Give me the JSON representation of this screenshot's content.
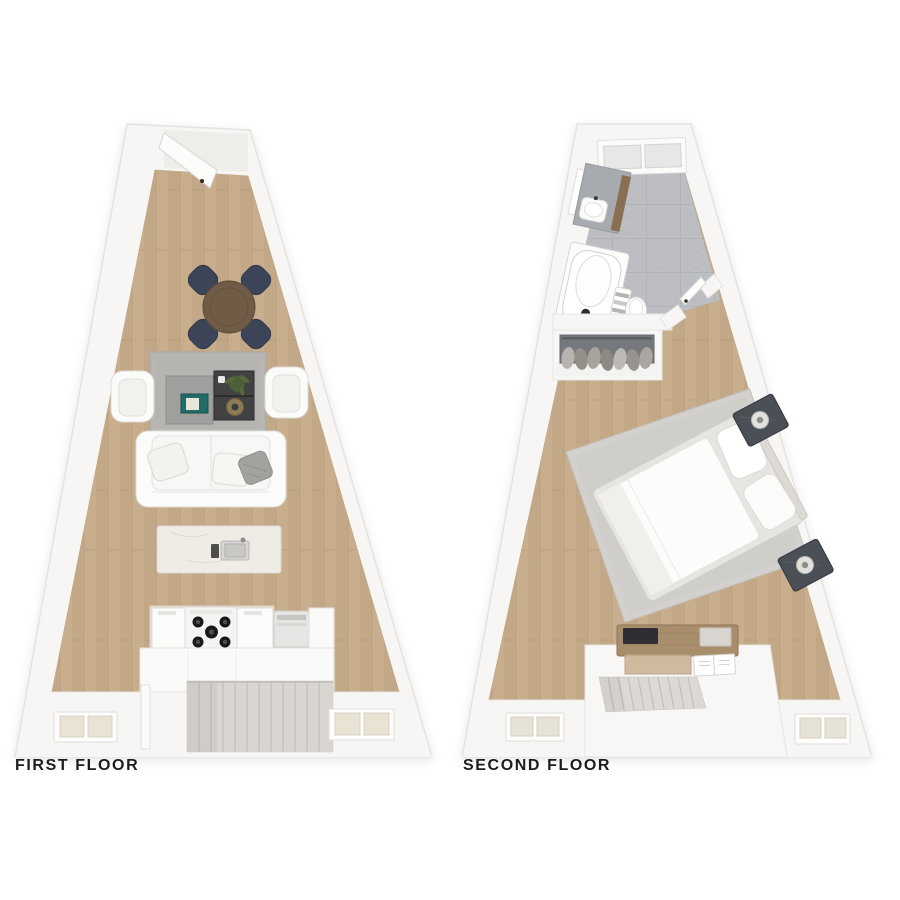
{
  "title": "Two-floor triangular apartment floor plan",
  "floors": [
    {
      "label": "FIRST FLOOR",
      "furniture": [
        "entry-door",
        "round-dining-table",
        "dining-chairs",
        "area-rug",
        "armchairs",
        "coffee-tables",
        "book",
        "plant",
        "sofa",
        "throw-pillows",
        "kitchen-island-with-sink",
        "kitchen-counter-with-stove",
        "appliance",
        "staircase",
        "partition-wall",
        "windows"
      ]
    },
    {
      "label": "SECOND FLOOR",
      "furniture": [
        "window",
        "bathroom-vanity-with-sink",
        "mirror",
        "bathtub",
        "towel-rack",
        "toilet",
        "bathroom-door",
        "closet-with-hanging-clothes",
        "bedroom-rug",
        "bed-with-pillows",
        "nightstands-with-lamps",
        "dresser",
        "wood-tray",
        "open-book",
        "staircase",
        "stair-half-wall",
        "windows"
      ]
    }
  ],
  "colors": {
    "background": "#ffffff",
    "label_text": "#1c1c1c",
    "wall": "#f7f6f4",
    "wall_edge": "#e5e3e0",
    "wood": "#c9ae8d",
    "wood_dark": "#bda081",
    "tile": "#bcbec2",
    "tile_line": "#adb0b5",
    "rug_first": "#b5b4b1",
    "rug_second": "#d2d1ce",
    "furniture_white": "#fbfbfa",
    "furniture_edge": "#dedbd6",
    "table_walnut": "#6f5b46",
    "chair_navy": "#3c4558",
    "coffee_charcoal": "#424143",
    "coffee_gray": "#a09f9d",
    "marble": "#e9e2d6",
    "island_marble": "#efece6",
    "closet_gray": "#75787d",
    "dresser_wood": "#a98e6c",
    "stair": "#d9d6d2",
    "stair_line": "#c2bfbb",
    "book_teal": "#226b66",
    "plant_green": "#4c5f35",
    "nightstand_dark": "#4b4f56",
    "window_pane": "#e9e3d3",
    "window_pane2": "#e6e8e5"
  }
}
